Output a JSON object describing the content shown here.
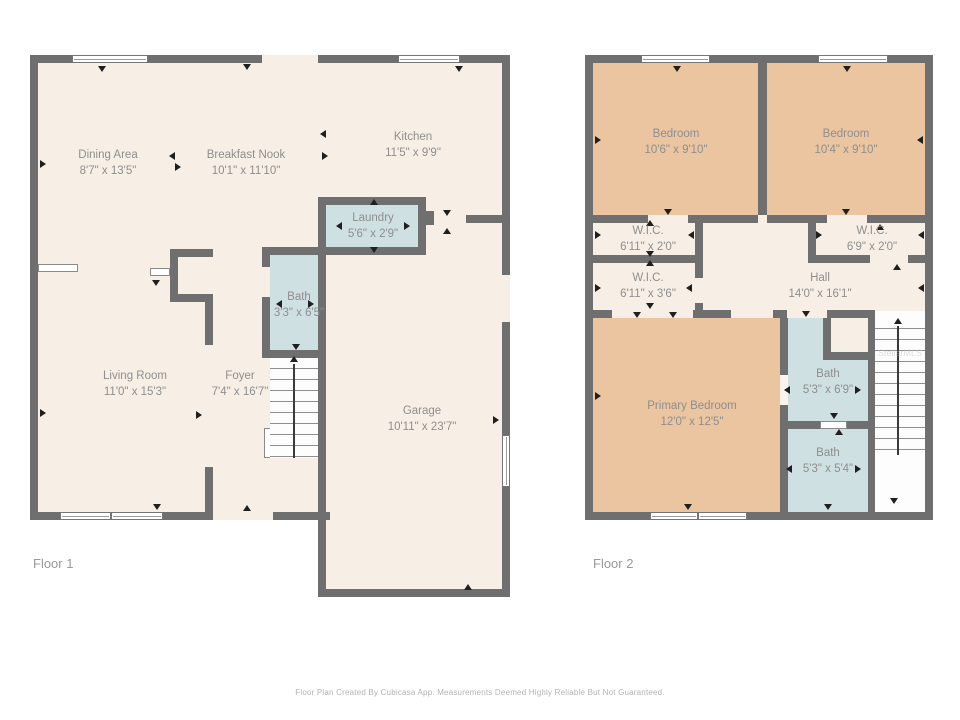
{
  "colors": {
    "wall": "#6f6f6f",
    "floor": "#f7efe6",
    "bedroom": "#eac5a0",
    "wet_room": "#cfe0e2",
    "label_text": "#8e8e8e"
  },
  "floor1": {
    "title": "Floor 1",
    "rooms": [
      {
        "name": "Dining Area",
        "dims": "8'7\" x 13'5\""
      },
      {
        "name": "Breakfast Nook",
        "dims": "10'1\" x 11'10\""
      },
      {
        "name": "Kitchen",
        "dims": "11'5\" x 9'9\""
      },
      {
        "name": "Laundry",
        "dims": "5'6\" x 2'9\""
      },
      {
        "name": "Bath",
        "dims": "3'3\" x 6'5\""
      },
      {
        "name": "Living Room",
        "dims": "11'0\" x 15'3\""
      },
      {
        "name": "Foyer",
        "dims": "7'4\" x 16'7\""
      },
      {
        "name": "Garage",
        "dims": "10'11\" x 23'7\""
      }
    ]
  },
  "floor2": {
    "title": "Floor 2",
    "rooms": [
      {
        "name": "Bedroom",
        "dims": "10'6\" x 9'10\""
      },
      {
        "name": "Bedroom",
        "dims": "10'4\" x 9'10\""
      },
      {
        "name": "W.I.C.",
        "dims": "6'11\" x 2'0\""
      },
      {
        "name": "W.I.C.",
        "dims": "6'9\" x 2'0\""
      },
      {
        "name": "W.I.C.",
        "dims": "6'11\" x 3'6\""
      },
      {
        "name": "Hall",
        "dims": "14'0\" x 16'1\""
      },
      {
        "name": "Primary Bedroom",
        "dims": "12'0\" x 12'5\""
      },
      {
        "name": "Bath",
        "dims": "5'3\" x 6'9\""
      },
      {
        "name": "Bath",
        "dims": "5'3\" x 5'4\""
      }
    ]
  },
  "watermark": {
    "text": "StellarMLS"
  },
  "footer": {
    "disclaimer": "Floor Plan Created By Cubicasa App. Measurements Deemed Highly Reliable But Not Guaranteed."
  }
}
